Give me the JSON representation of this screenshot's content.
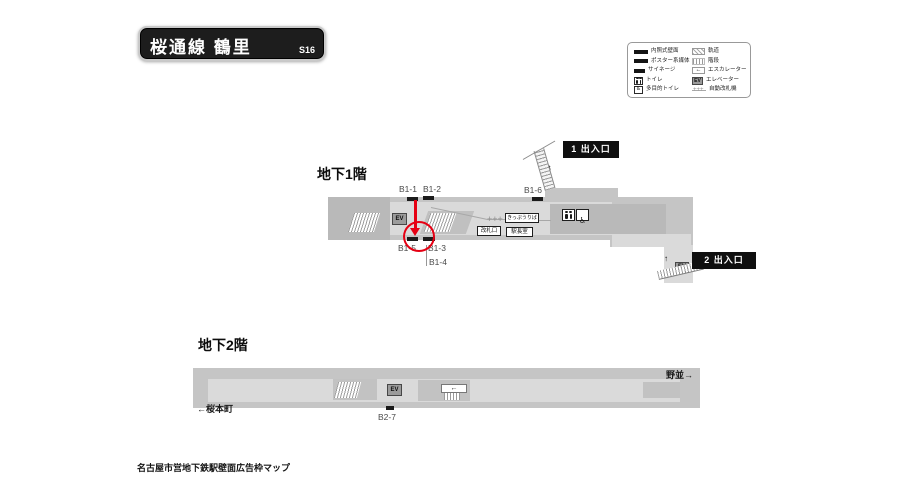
{
  "header": {
    "title": "桜通線 鶴里",
    "station_code": "S16"
  },
  "legend": {
    "left": [
      {
        "icon": "wall-media-icon",
        "label": "内照式壁面"
      },
      {
        "icon": "poster-media-icon",
        "label": "ポスター系媒体"
      },
      {
        "icon": "signage-icon",
        "label": "サイネージ"
      },
      {
        "icon": "toilet-icon",
        "label": "トイレ"
      },
      {
        "icon": "accessible-toilet-icon",
        "label": "多目的トイレ"
      }
    ],
    "right": [
      {
        "icon": "track-icon",
        "label": "軌道"
      },
      {
        "icon": "stairs-icon",
        "label": "階段"
      },
      {
        "icon": "escalator-icon",
        "label": "エスカレーター"
      },
      {
        "icon": "elevator-icon",
        "label": "エレベーター"
      },
      {
        "icon": "ticket-gate-icon",
        "label": "自動改札機"
      }
    ]
  },
  "floors": {
    "b1": {
      "title": "地下1階",
      "exit1_label": "1 出入口",
      "exit2_label": "2 出入口",
      "positions": [
        "B1-1",
        "B1-2",
        "B1-3",
        "B1-4",
        "B1-5",
        "B1-6"
      ],
      "rooms": {
        "ticket_office": "きっぷうりば",
        "gate": "改札口",
        "station_office": "駅長室"
      }
    },
    "b2": {
      "title": "地下2階",
      "positions": [
        "B2-7"
      ],
      "direction_right": "野並→",
      "direction_left": "←桜本町"
    }
  },
  "misc": {
    "ev_label": "EV",
    "plus_marks": "+++"
  },
  "icons": {
    "up_arrow": "↑",
    "left_arrow": "←"
  },
  "footer": {
    "caption": "名古屋市営地下鉄駅壁面広告枠マップ"
  }
}
